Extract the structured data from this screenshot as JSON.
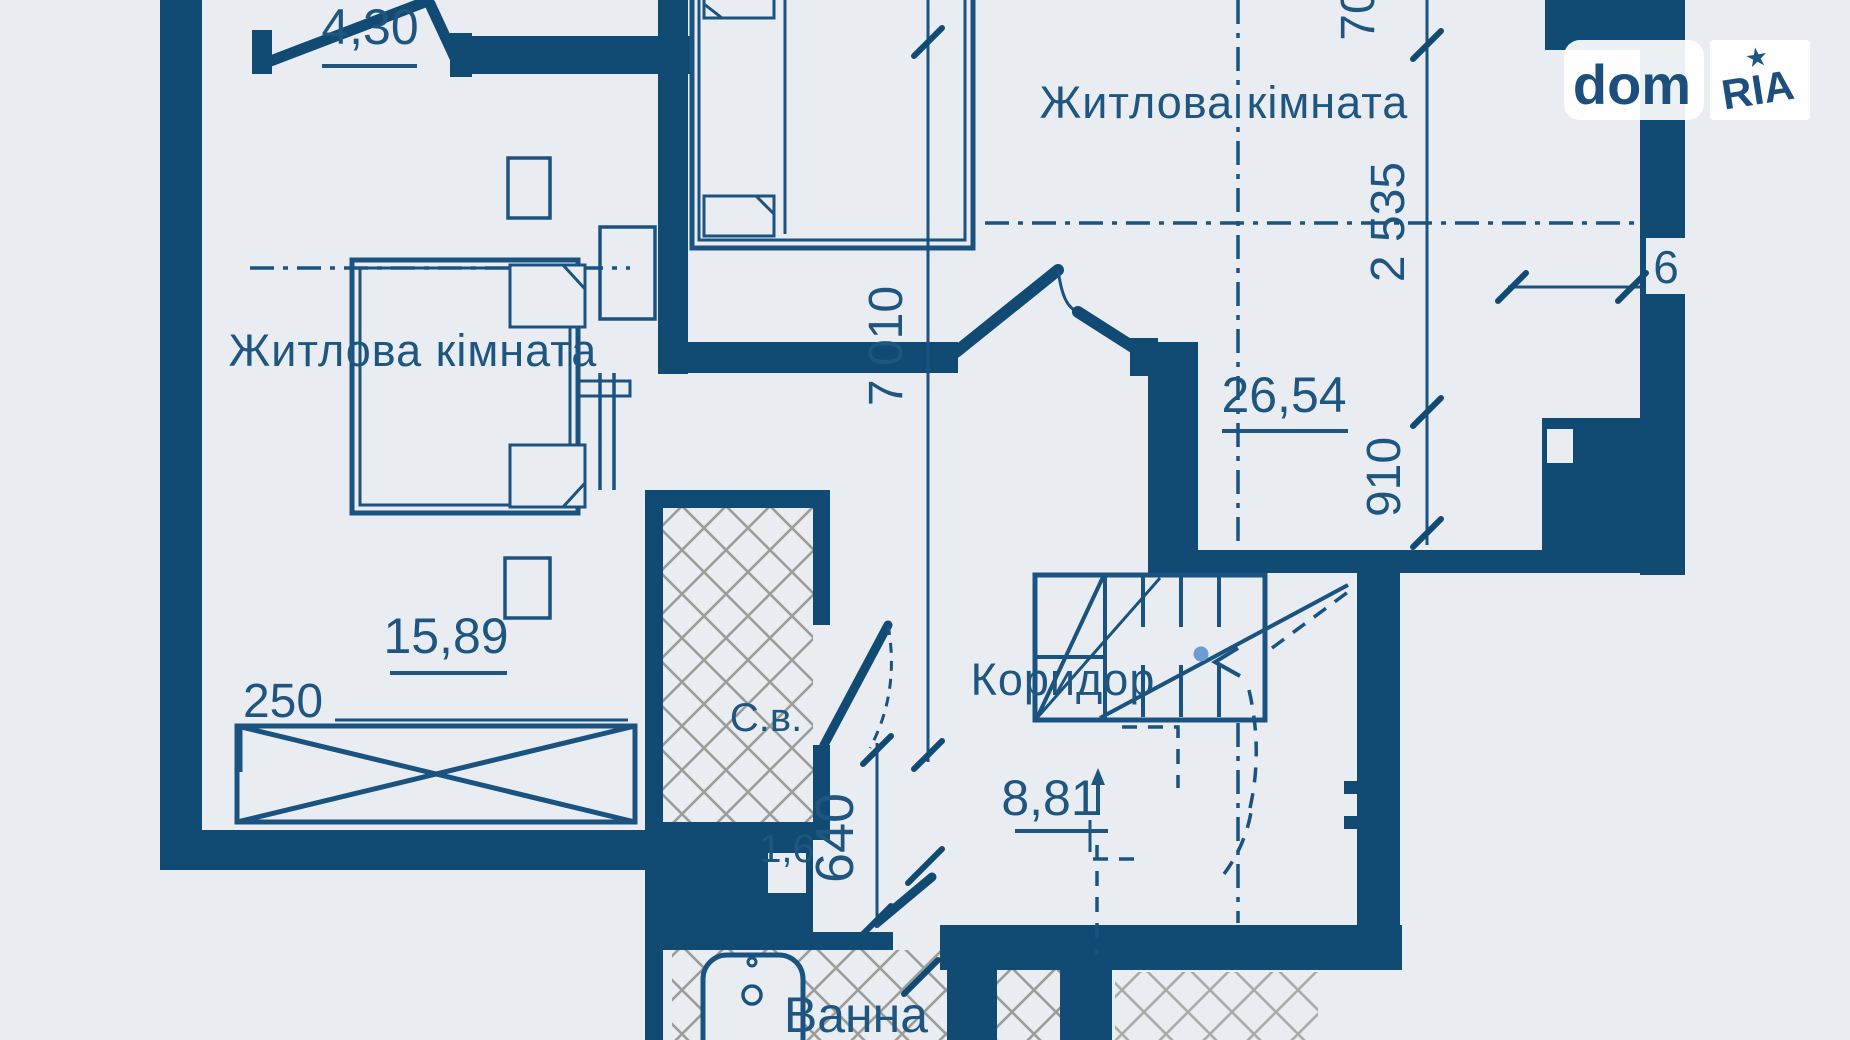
{
  "logo": {
    "dom": "dom",
    "ria": "RIA",
    "star": "★"
  },
  "rooms": {
    "bedroom_left": {
      "label": "Житлова кімната",
      "area": "15,89"
    },
    "living_right": {
      "label": "Житлова кімната",
      "area": "26,54"
    },
    "corridor": {
      "label": "Коридор",
      "area": "8,81"
    },
    "sanitary": {
      "label": "С.в.",
      "area": "1,6"
    },
    "bath": {
      "label": "Ванна"
    },
    "balcony": {
      "area": "4,30"
    }
  },
  "dimensions": {
    "vertical_main": "7 010",
    "right_top_partial": "70",
    "right_upper": "2 535",
    "right_lower": "910",
    "wardrobe_width": "250",
    "sanitary_width": "640",
    "wall_notch": "6"
  },
  "colors": {
    "background": "#e9edf2",
    "ink": "#114a73",
    "tile": "#9c9c98",
    "dot": "#6d9bd3"
  }
}
